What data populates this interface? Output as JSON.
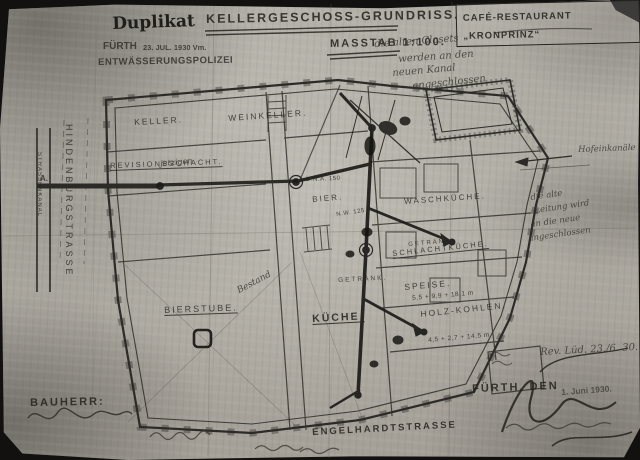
{
  "document": {
    "duplicate_mark": "Duplikat",
    "title": "KELLERGESCHOSS-GRUNDRISS.",
    "scale": "MASSTAB 1:100.",
    "project_box": "CAFÉ-RESTAURANT „KRONPRINZ“",
    "stamp": {
      "city": "FÜRTH",
      "date": "23. JUL. 1930 Vm.",
      "office": "ENTWÄSSERUNGSPOLIZEI"
    },
    "client_label": "BAUHERR:",
    "place_date_label": "FÜRTH, DEN",
    "date_stamp": "1. Juni 1930.",
    "revision_note": "Rev. Lüd. 23./6. 30."
  },
  "streets": {
    "left_vertical": "HINDENBURGSTRASSE",
    "canal": "STRASSENKANAL",
    "bottom": "ENGELHARDTSTRASSE",
    "court_canal": "Hofeinkanäle"
  },
  "rooms": [
    {
      "label": "KELLER."
    },
    {
      "label": "WEINKELLER."
    },
    {
      "label": "REVISIONSSCHACHT."
    },
    {
      "label": "BIER."
    },
    {
      "label": "WASCHKÜCHE."
    },
    {
      "label": "GETRÄNK."
    },
    {
      "label": "SCHLACHTKÜCHE."
    },
    {
      "label": "GETRÄNK."
    },
    {
      "label": "KÜCHE."
    },
    {
      "label": "BIERSTUBE."
    },
    {
      "label": "SPEISE."
    },
    {
      "label": "HOLZ-KOHLEN."
    }
  ],
  "annotations": {
    "note_top_lines": [
      "die alten Closets",
      "werden an den",
      "neuen Kanal",
      "angeschlossen"
    ],
    "note_right_lines": [
      "die alte",
      "Leitung wird",
      "an die neue",
      "angeschlossen"
    ],
    "bestand": "Bestand",
    "jetzigen": "jetzigen",
    "marker_a": "A.",
    "pipe1": "D.N.A. 150",
    "pipe2": "N.W. 125",
    "dim_speise": "5,5 + 9,9 + 18,1 m",
    "dim_holz": "4,5 + 2,7 + 14,5 m"
  }
}
